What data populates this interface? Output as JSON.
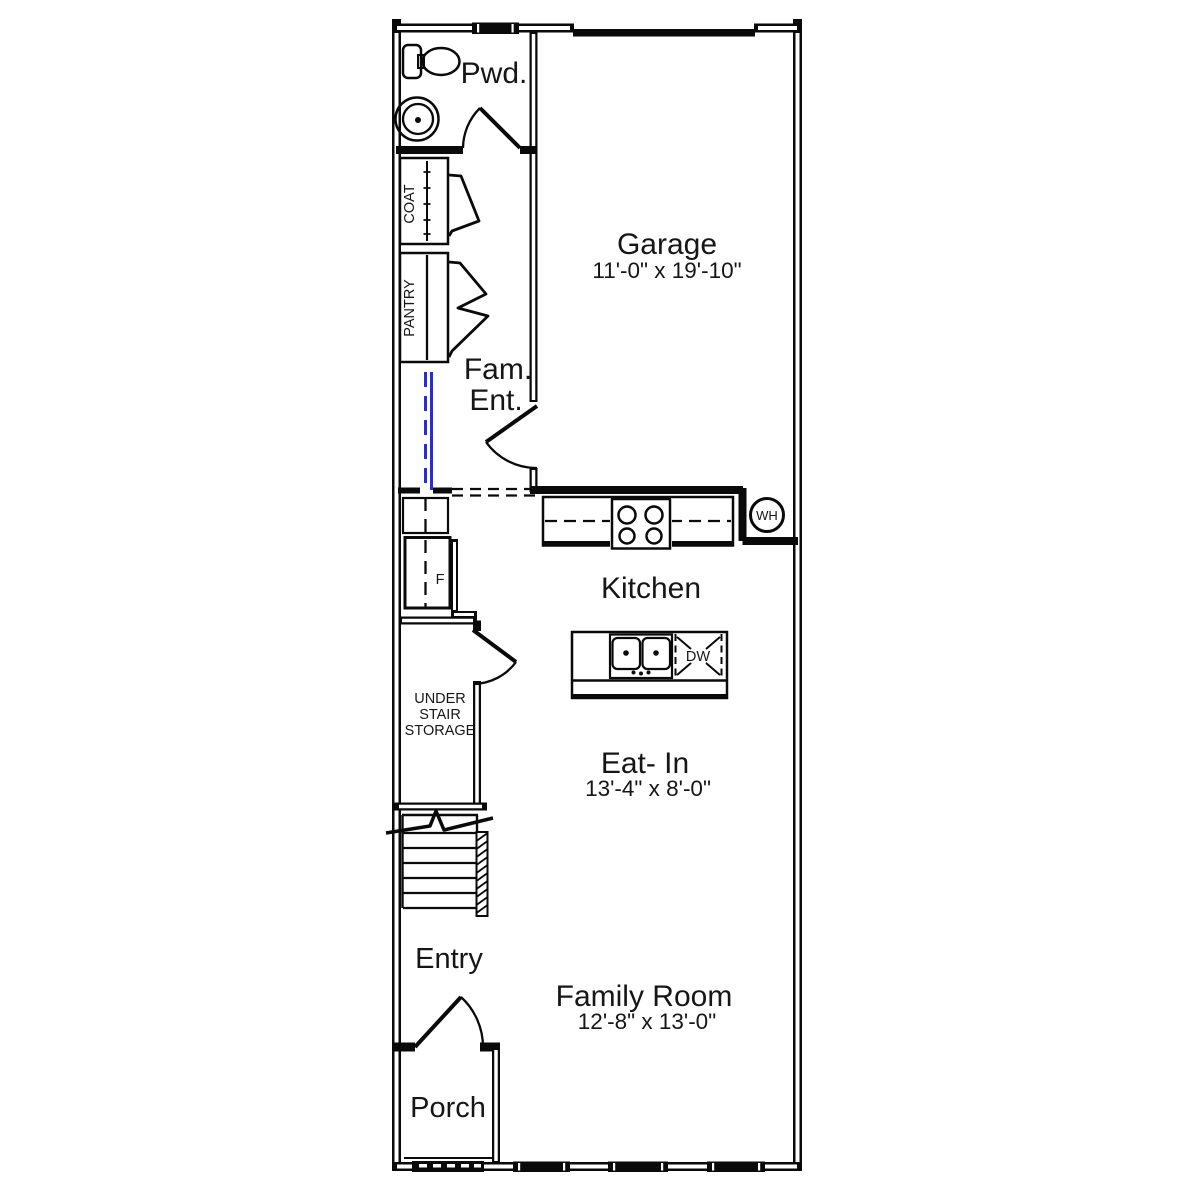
{
  "rooms": {
    "pwd": {
      "label": "Pwd."
    },
    "garage": {
      "label": "Garage",
      "dims": "11'-0\" x 19'-10\""
    },
    "coat": {
      "label": "COAT"
    },
    "pantry": {
      "label": "PANTRY"
    },
    "fam_ent": {
      "label_line1": "Fam.",
      "label_line2": "Ent."
    },
    "kitchen": {
      "label": "Kitchen"
    },
    "eat_in": {
      "label": "Eat- In",
      "dims": "13'-4\" x 8'-0\""
    },
    "under_stair_storage": {
      "label_line1": "UNDER",
      "label_line2": "STAIR",
      "label_line3": "STORAGE"
    },
    "entry": {
      "label": "Entry"
    },
    "family_room": {
      "label": "Family Room",
      "dims": "12'-8\" x 13'-0\""
    },
    "porch": {
      "label": "Porch"
    }
  },
  "fixtures": {
    "water_heater": {
      "label": "WH"
    },
    "dishwasher": {
      "label": "DW"
    },
    "refrigerator": {
      "label": "F"
    }
  },
  "colors": {
    "line": "#0a0a0a",
    "optional_wall_blue": "#2b2bd2",
    "background": "#ffffff"
  }
}
